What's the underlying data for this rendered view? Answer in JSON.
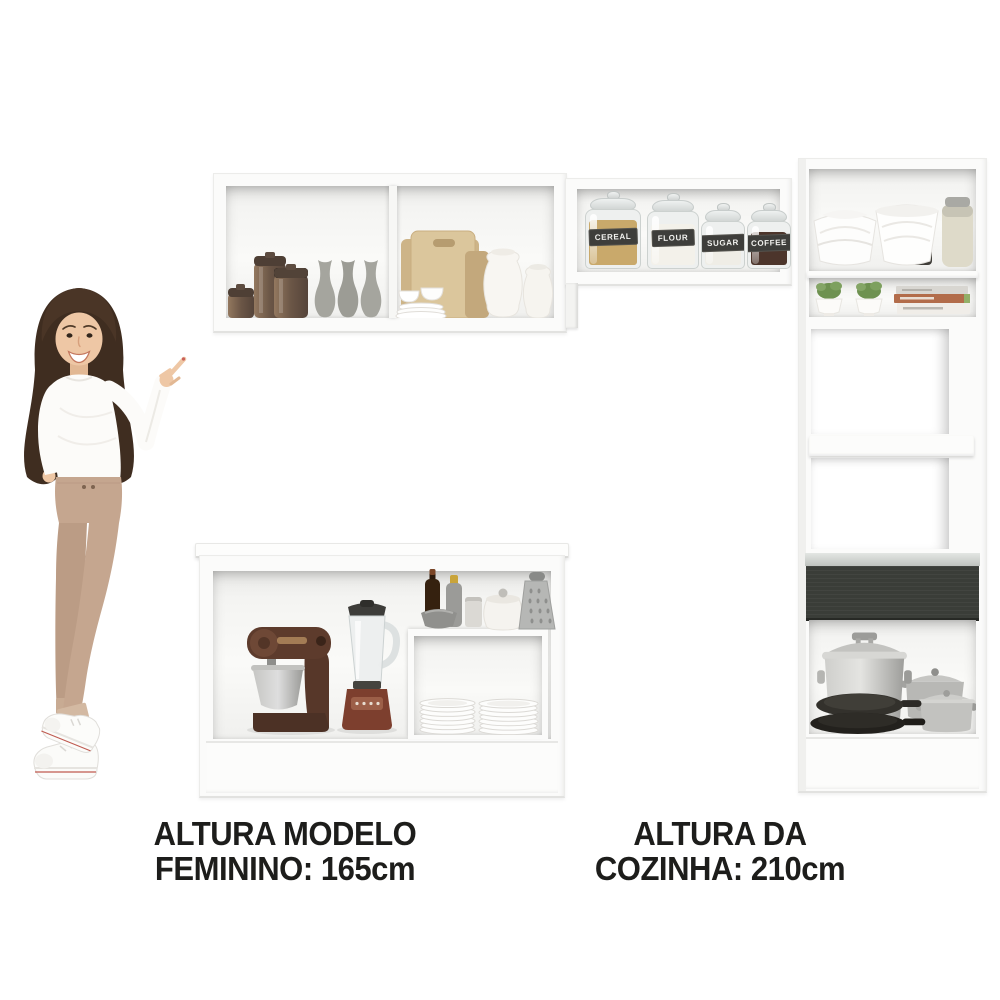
{
  "captions": {
    "model_height": {
      "line1": "ALTURA MODELO",
      "line2": "FEMININO: 165cm"
    },
    "kitchen_height": {
      "line1": "ALTURA DA",
      "line2": "COZINHA: 210cm"
    }
  },
  "pantry_jars": {
    "labels": [
      "CEREAL",
      "FLOUR",
      "SUGAR",
      "COFFEE"
    ]
  },
  "colors": {
    "text": "#1d1d1b",
    "cabinet_white": "#fbfbfa",
    "drawer_front_dark": "#3a3d38",
    "appliance_copper": "#7d3f2e",
    "wood_board_tan": "#dbc69c",
    "plant_green": "#6e9150",
    "book_spine_orange": "#b26c4a"
  }
}
